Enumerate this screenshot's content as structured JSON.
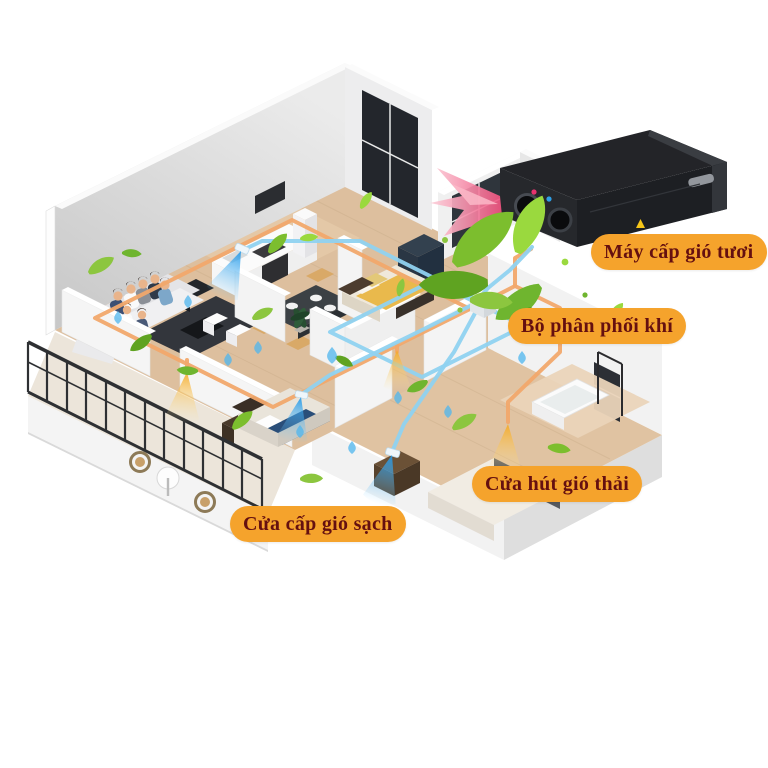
{
  "diagram": {
    "type": "isometric-apartment-fresh-air-system",
    "labels": {
      "fresh_air_unit": "Máy cấp gió tươi",
      "air_distributor": "Bộ phân phối khí",
      "exhaust_air_vent": "Cửa hút gió thải",
      "supply_air_vent": "Cửa cấp gió sạch"
    },
    "colors": {
      "label_bg": "#F5A32C",
      "label_text": "#651010",
      "supply_duct": "#8FD2F0",
      "exhaust_duct": "#F1A86B",
      "leaf_green": "#7CBE2E",
      "exhaust_pink": "#F0628A",
      "machine_body": "#232428",
      "floor_wood": "#DDBF9E",
      "wall_gray": "#D9D9D9"
    }
  }
}
